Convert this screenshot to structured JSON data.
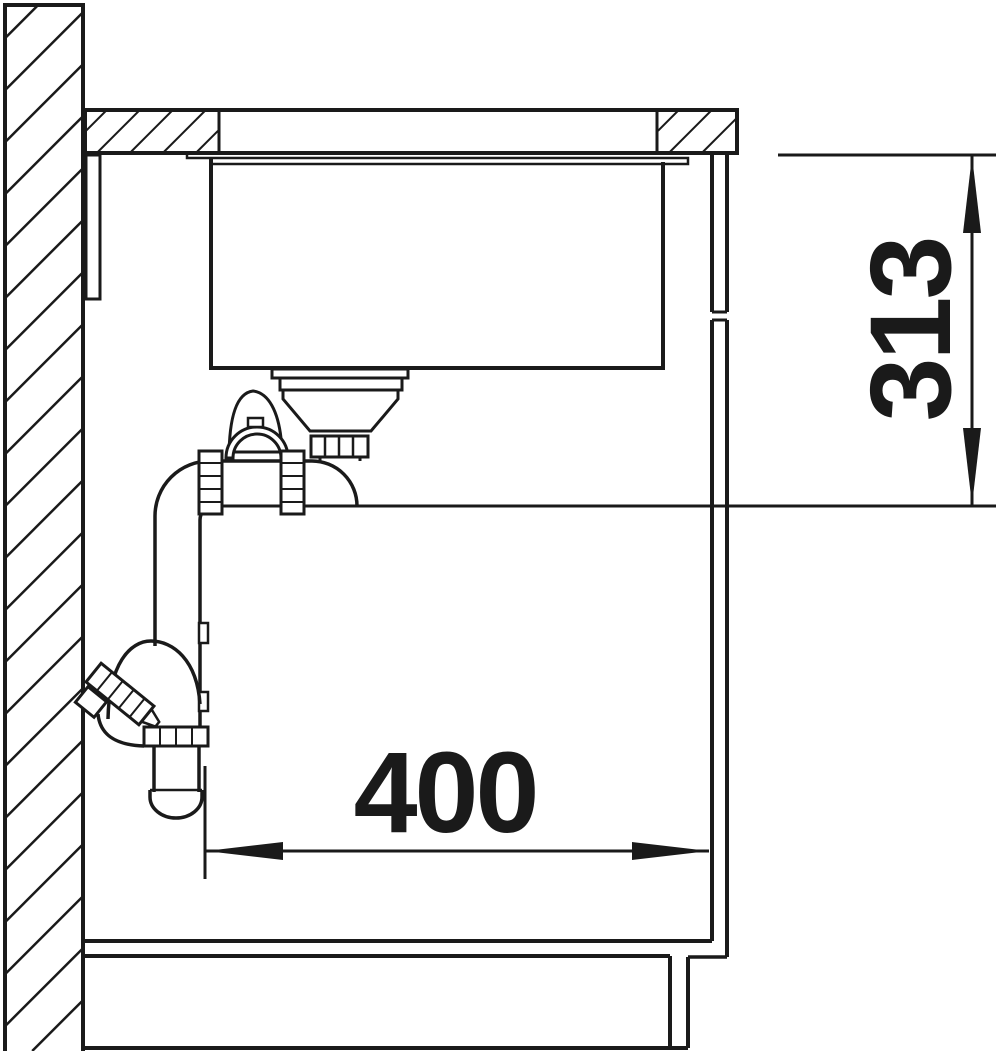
{
  "diagram": {
    "type": "sink-installation-side-section",
    "background_color": "#ffffff",
    "line_color": "#1a1a1a",
    "dimensions": {
      "vertical_dimension": {
        "label": "313",
        "orientation": "vertical"
      },
      "horizontal_dimension": {
        "label": "400",
        "orientation": "horizontal"
      }
    },
    "parts": {
      "wall": "hatched-wall-section",
      "countertop": "hatched-countertop-section",
      "sink": "undermount-bowl",
      "drain": "strainer-and-trap-assembly",
      "cabinet": "side-panel-bottom-and-plinth"
    }
  }
}
